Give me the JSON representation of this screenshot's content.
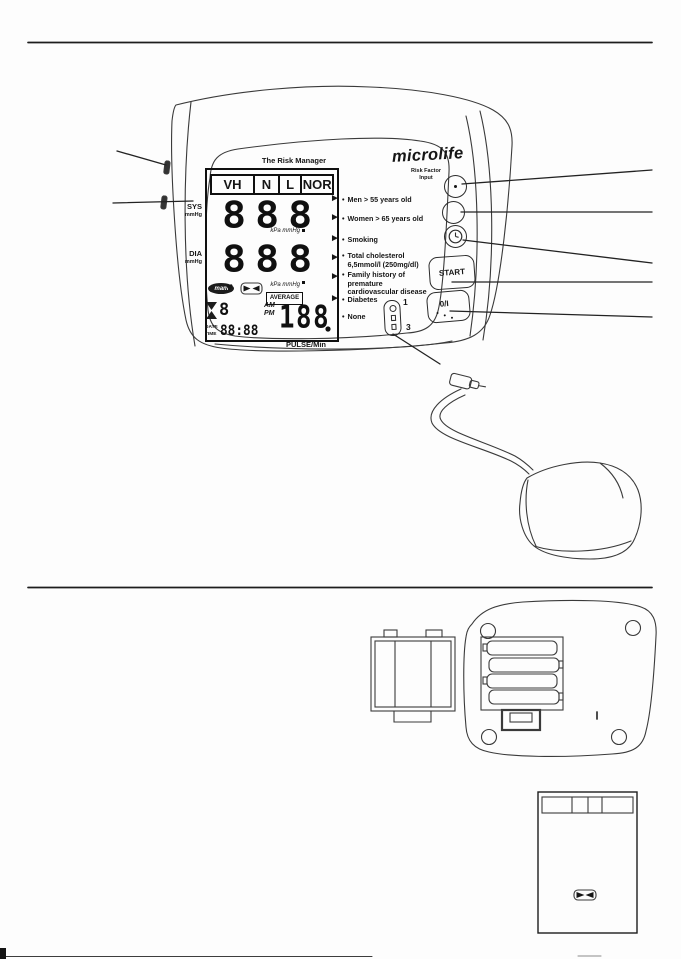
{
  "device_front": {
    "brand": "microlife",
    "panel_title": "The Risk Manager",
    "display": {
      "classes": [
        "VH",
        "N",
        "L",
        "NOR"
      ],
      "sys_label": "SYS",
      "sys_unit": "mmHg",
      "sys_digits": "888",
      "dia_label": "DIA",
      "dia_unit": "mmHg",
      "dia_digits": "888",
      "kpa_unit": "kPa mmHg",
      "mam_label": "mam",
      "average_label": "AVERAGE",
      "am_label": "AM",
      "pm_label": "PM",
      "aux_digit": "8",
      "date_label": "DATE",
      "time_label": "TIME",
      "datetime_digits": "88:88",
      "pulse_digits": "188",
      "pulse_unit": "PULSE/Min"
    },
    "risk_factors": [
      "Men > 55 years old",
      "Women > 65 years old",
      "Smoking",
      "Total cholesterol\n6,5mmol/l (250mg/dl)",
      "Family history of premature\ncardiovascular disease",
      "Diabetes",
      "None"
    ],
    "controls": {
      "risk_input_label": "Risk Factor\nInput",
      "start_label": "START",
      "power_label": "0/I",
      "switch_top": "1",
      "switch_bottom": "3"
    }
  },
  "icons": {
    "heart": "♥",
    "arrow": "►",
    "bullet": "•"
  },
  "line_color": "#3a3a3a"
}
